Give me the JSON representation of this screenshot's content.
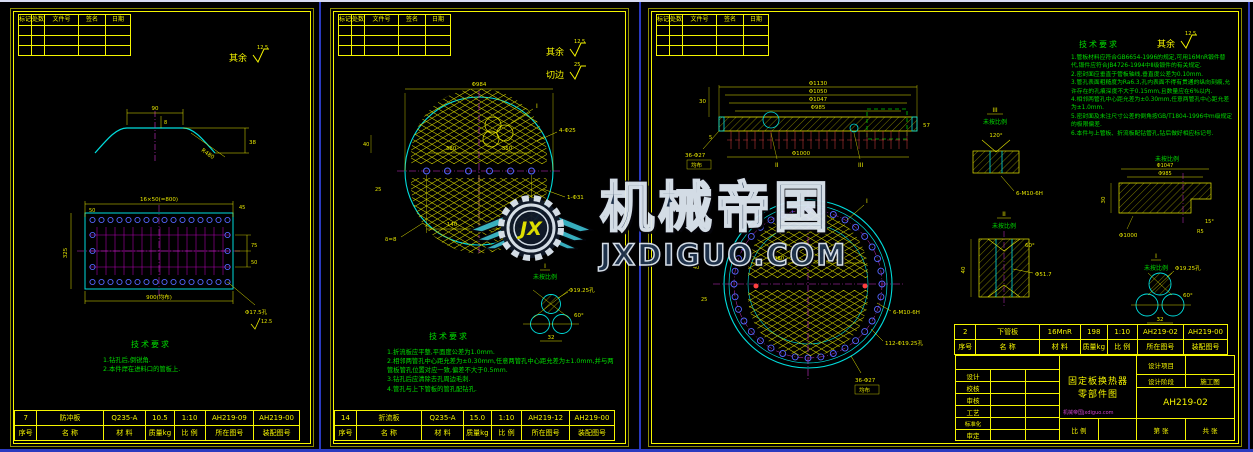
{
  "watermark": {
    "brand": "机械帝国",
    "site": "JXDIGUO.COM",
    "logo_text": "JX"
  },
  "colors": {
    "line": "#f5f500",
    "outline": "#00e0e0",
    "centerline": "#cc33cc",
    "notes": "#00dd00",
    "holes": "#5566ff",
    "watermark_teal": "#3ab7c8"
  },
  "common": {
    "revision_headers": [
      "标记",
      "处数",
      "文件号",
      "签名",
      "日期"
    ],
    "parts_headers": [
      "序号",
      "名 称",
      "材 料",
      "质量kg",
      "比 例",
      "所在图号",
      "装配图号"
    ],
    "tech_req_title": "技术要求",
    "surface_label": "其余",
    "trim_label": "切边",
    "not_to_scale": "未按比例"
  },
  "sheet1": {
    "roughness": "12.5",
    "part": {
      "seq": "7",
      "name": "防冲板",
      "material": "Q235-A",
      "mass": "10.5",
      "scale": "1:10",
      "drawing_no": "AH219-09",
      "assembly_no": "AH219-00"
    },
    "notes": [
      "1.钻孔后,倒锐角.",
      "2.本件焊在进料口的管板上."
    ],
    "dims": {
      "crown": "90",
      "drop": "8",
      "rise": "38",
      "radius": "R480",
      "pitch_total": "16×50(=800)",
      "pitch_first": "50",
      "side": "45",
      "height": "325",
      "bottom": "900(均布)",
      "row_a": "75",
      "row_b": "50",
      "hole": "Φ17.5孔",
      "finish": "12.5"
    }
  },
  "sheet2": {
    "roughness": "12.5",
    "trim_roughness": "25",
    "part": {
      "seq": "14",
      "name": "折流板",
      "material": "Q235-A",
      "mass": "15.0",
      "scale": "1:10",
      "drawing_no": "AH219-12",
      "assembly_no": "AH219-00"
    },
    "notes": [
      "1.折流板应平整,平面度公差为1.0mm.",
      "2.相邻两管孔中心距允差为±0.30mm,任意两管孔中心距允差为±1.0mm,并与两管板管孔位置对应一致,偏差不大于0.5mm.",
      "3.钻孔后应清除去孔周边毛刺.",
      "4.管孔与上下管板的管孔配钻孔."
    ],
    "dims": {
      "dia": "Φ984",
      "row_l": "380",
      "row_r": "350",
      "left_a": "40",
      "left_b": "25",
      "bot_a": "140",
      "bot_b": "140",
      "thick": "δ=8",
      "holes4": "4-Φ25",
      "hole1": "1-Φ31",
      "callout": "I",
      "det_label": "I",
      "det_hole": "Φ19.25孔",
      "det_pitch": "32",
      "det_angle": "60°"
    }
  },
  "sheet3": {
    "roughness": "12.5",
    "part": {
      "seq": "2",
      "name": "下管板",
      "material": "16MnR",
      "mass": "198",
      "scale": "1:10",
      "drawing_no": "AH219-02",
      "assembly_no": "AH219-00"
    },
    "notes": [
      "1.管板材料应符合GB6654-1996的规定,可用16MnR锻件替代,锻件应符合JB4726-1994中Ⅱ级锻件的有关规定.",
      "2.密封面应垂直于管板轴线,垂直度公差为0.10mm.",
      "3.管孔表面粗糙度为Ra6.3,孔内表面不得有贯通的纵向刻痕,允许存在的孔痕深度不大于0.15mm,且数量应在6%以内.",
      "4.相邻两管孔中心距允差为±0.30mm,任意两管孔中心距允差为±1.0mm.",
      "5.密封面及未注尺寸公差的倒角按GB/T1804-1996中m级规定的极限偏差.",
      "6.本件与上管板、折流板配钻管孔,钻后做好相应标记号."
    ],
    "section": {
      "d1": "Φ1130",
      "d2": "Φ1050",
      "d3": "Φ1047",
      "d4": "Φ985",
      "d5": "Φ1000",
      "left_a": "30",
      "left_b": "5",
      "right_a": "57",
      "sec2": "II",
      "sec3": "III",
      "holes": "36-Φ27",
      "holes_note": "均布"
    },
    "circle": {
      "callout": "I",
      "thread": "6-M10-6H",
      "tubes": "112-Φ19.25孔",
      "bolts": "36-Φ27",
      "bolts_note": "均布",
      "row_l": "380",
      "row_r": "350",
      "left_a": "40",
      "left_b": "25"
    },
    "det3": {
      "label": "III",
      "angle": "120°",
      "thread": "6-M10-6H"
    },
    "det2": {
      "label": "II",
      "dia": "Φ51.7",
      "height": "40",
      "angle": "60°"
    },
    "groove": {
      "d1": "Φ1047",
      "d2": "Φ985",
      "d3": "Φ1000",
      "height": "30",
      "angle": "15°",
      "radius": "R5"
    },
    "det1": {
      "label": "I",
      "hole": "Φ19.25孔",
      "pitch": "32",
      "angle": "60°"
    },
    "title_block": {
      "sign_rows": [
        "设计",
        "校核",
        "审核",
        "工艺",
        "标准化",
        "审定"
      ],
      "product_line1": "固定板换热器",
      "product_line2": "零部件图",
      "proj_label": "设计项目",
      "stage_label": "设计阶段",
      "stage_value": "施工图",
      "drawing_no": "AH219-02",
      "scale_label": "比 例",
      "sheet_label": "第 张",
      "total_label": "共 张",
      "watermark_small": "机械帝国jxdiguo.com"
    }
  }
}
